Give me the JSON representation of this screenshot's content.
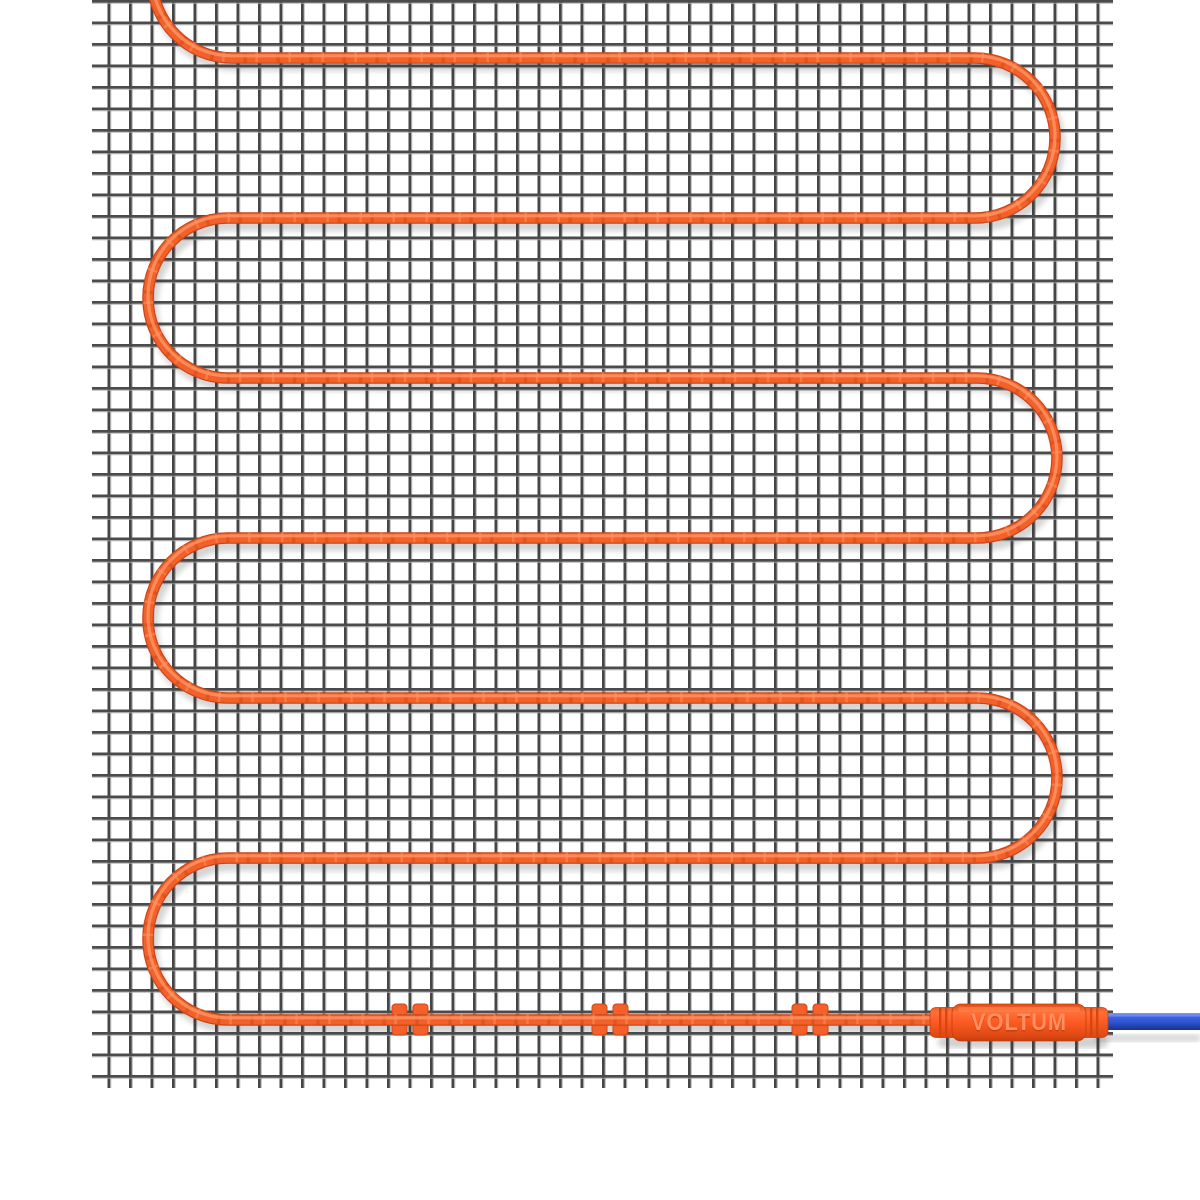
{
  "product": {
    "brand_label": "VOLTUM"
  },
  "heating_cable": {
    "color": "#F2612B",
    "dark_edge_color": "#C9441A",
    "highlight_color": "#FF9A66",
    "wrap_band_color": "#CF4B18",
    "visible_rows": 7,
    "clip_count": 3
  },
  "clips": {
    "color": "#F4602A",
    "edge_color": "#CC4716"
  },
  "connector": {
    "body_color": "#FB5A22",
    "ridge_color": "#D2440F",
    "label_front_color": "#FF8E60",
    "label_shadow_color": "#C83E0E"
  },
  "cold_lead": {
    "color": "#2B50CC",
    "dark_edge_color": "#16348C",
    "highlight_color": "#6F8FF0"
  },
  "mesh": {
    "wire_color": "#474747",
    "bevel_color": "#A5A5A5",
    "background_color": "#FFFFFF"
  }
}
